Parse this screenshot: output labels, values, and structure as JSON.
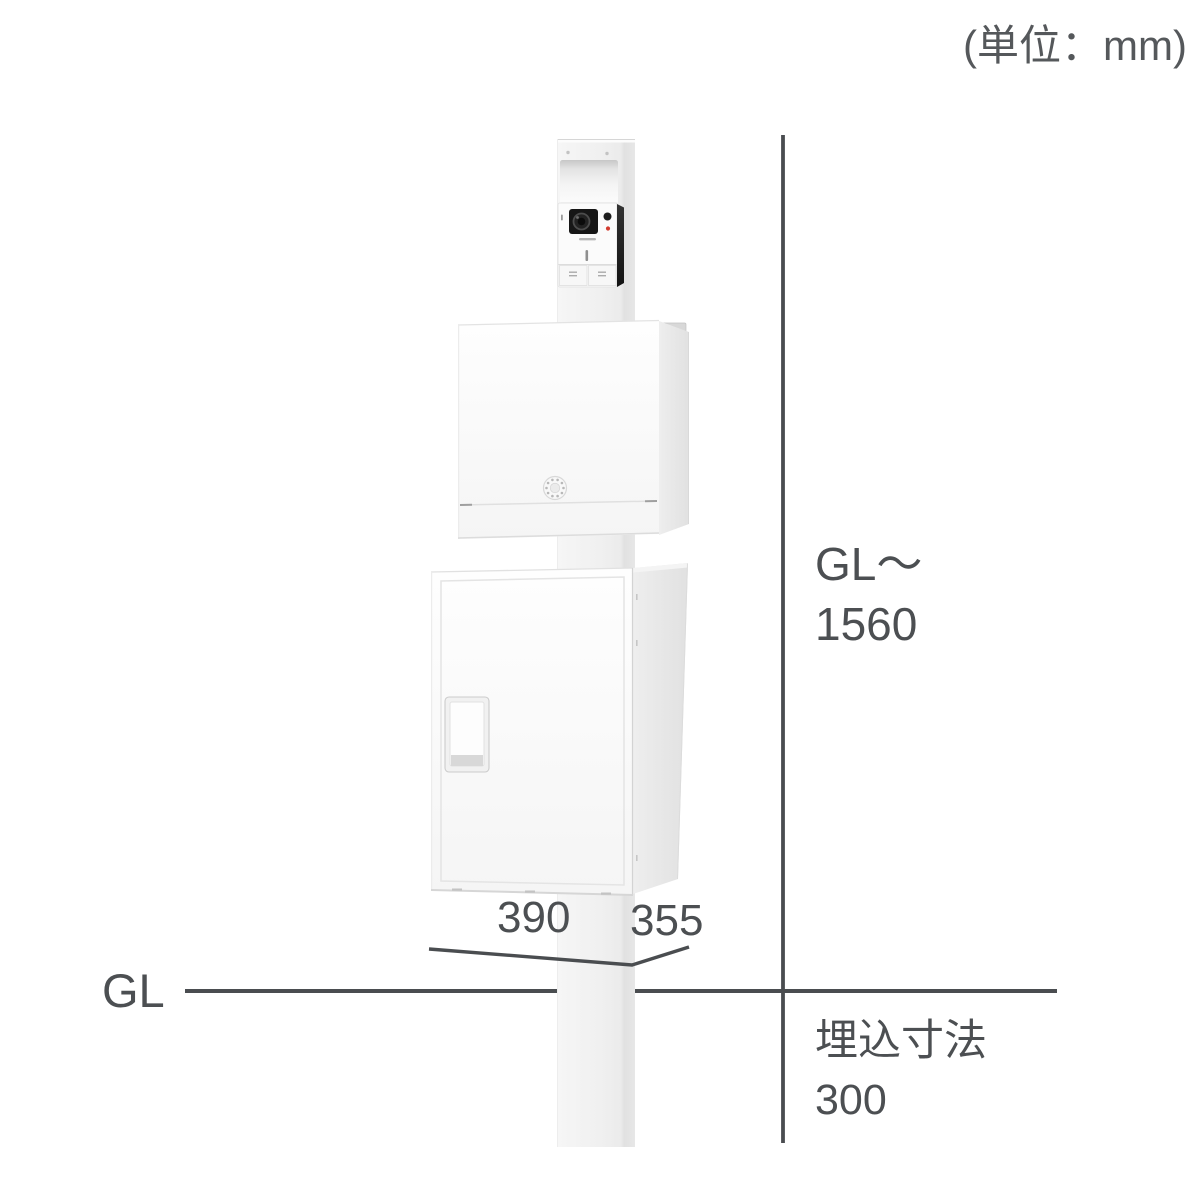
{
  "unit_note": "(単位：mm)",
  "labels": {
    "height": {
      "line1": "GL〜",
      "line2": "1560"
    },
    "width_front": "390",
    "depth_side": "355",
    "ground": "GL",
    "embed": {
      "line1": "埋込寸法",
      "line2": "300"
    }
  },
  "colors": {
    "background": "#ffffff",
    "dimension_line": "#4a4d50",
    "text": "#4c4f52",
    "unit_text": "#55585b",
    "pole": "#f1f1f1",
    "box_front": "#fbfbfb",
    "box_side": "#e6e6e6",
    "intercom_dark_edge": "#1f1f1f",
    "led_red": "#d23b2f"
  }
}
